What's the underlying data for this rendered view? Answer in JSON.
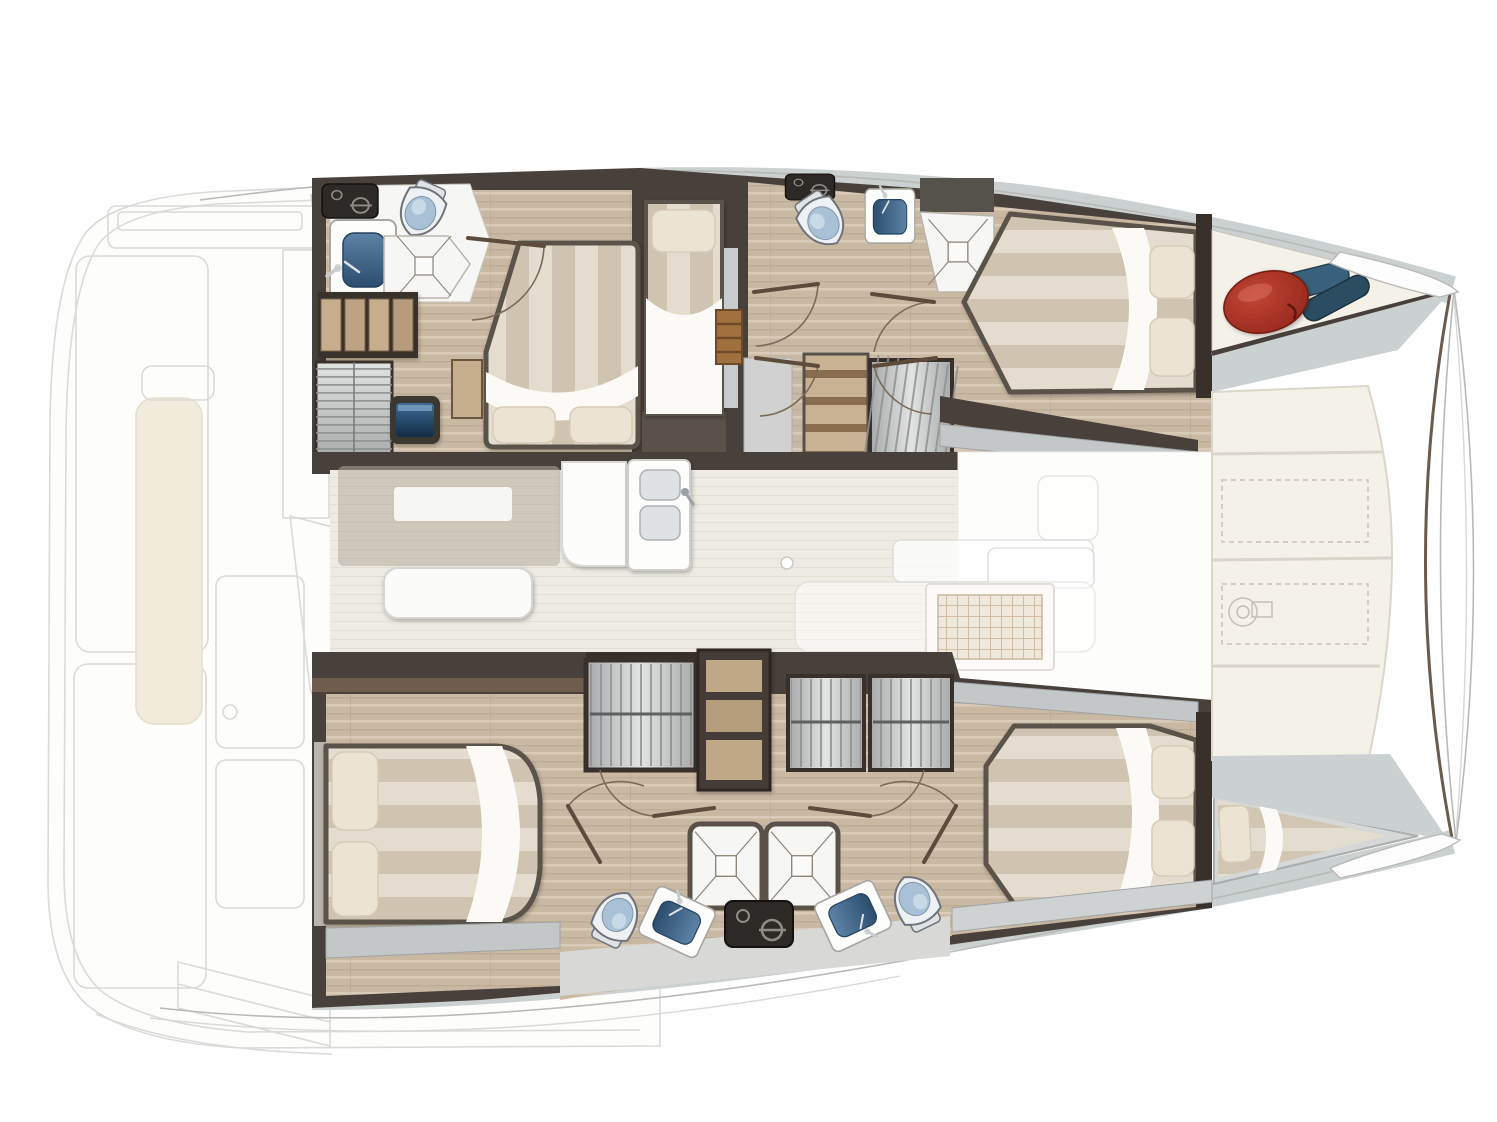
{
  "meta": {
    "type": "yacht-floor-plan",
    "vessel": "catamaran",
    "view": "top-down-deck-plan",
    "orientation": {
      "bow": "right",
      "stern": "left"
    },
    "canvas": {
      "width": 1497,
      "height": 1122
    }
  },
  "regions": [
    {
      "id": "aft-cockpit-ghost",
      "rendered": "faint-outline"
    },
    {
      "id": "port-hull-aft-cabin",
      "rendered": "solid"
    },
    {
      "id": "port-hull-aft-bathroom",
      "rendered": "solid"
    },
    {
      "id": "port-hull-single-berth-cabin",
      "rendered": "solid"
    },
    {
      "id": "port-hull-forward-cabin",
      "rendered": "solid"
    },
    {
      "id": "port-hull-forward-bathroom",
      "rendered": "solid"
    },
    {
      "id": "port-forepeak-gear-locker",
      "rendered": "solid"
    },
    {
      "id": "salon-galley",
      "rendered": "solid"
    },
    {
      "id": "foredeck-lockers",
      "rendered": "solid"
    },
    {
      "id": "starboard-hull-aft-cabin",
      "rendered": "solid"
    },
    {
      "id": "starboard-hull-bathrooms",
      "rendered": "solid"
    },
    {
      "id": "starboard-hull-forward-cabin",
      "rendered": "solid"
    },
    {
      "id": "starboard-forepeak-berth",
      "rendered": "solid"
    }
  ],
  "fixture_counts": {
    "double_beds": 4,
    "single_berths": 2,
    "toilets": 4,
    "showers": 4,
    "bathroom_sinks": 4,
    "galley_sink_bowls": 2,
    "hanging_lockers": 4,
    "shelf_units": 2,
    "companionway_stairs": 3,
    "door_swings": 9,
    "tv_screens": 1
  },
  "deck_details": {
    "locker_panels": 4,
    "dashed_hatches": 2,
    "windlass_symbol": true,
    "bow_gear": [
      "red-fender",
      "blue-fender-pair"
    ]
  },
  "palette": {
    "white": "#ffffff",
    "wall": "#48403a",
    "wallDark": "#38312b",
    "trimBrown": "#6f5e4d",
    "woodFloor": "#c9b8a2",
    "woodFloorLight": "#ddd0bd",
    "salonFloor": "#edebe3",
    "salonStreak": "#e2dfd5",
    "deckMarble": "#cbd0d0",
    "grayWood": "#c3c7c8",
    "grayWoodLine": "#9fa4a6",
    "cream": "#f4f1e9",
    "creamLine": "#d9d5c8",
    "bedStripeLight": "#e4ddcf",
    "bedStripeDark": "#cfc4af",
    "sheetWhite": "#fbfaf6",
    "pillow": "#ece4d3",
    "pillowLine": "#d6cbb6",
    "bedFrame": "#5a5248",
    "fixtureBlack": "#2c2926",
    "fixtureGlyph": "#8f8c87",
    "sinkBlueA": "#5d83a6",
    "sinkBlueB": "#2c4d6e",
    "toiletLid": "#a9c1d6",
    "toiletBody": "#eef1f4",
    "toiletLine": "#6f747b",
    "showerFloor": "#f6f6f4",
    "showerLine": "#8d8679",
    "louverA": "#e2e3e3",
    "louverB": "#a7a9aa",
    "louverLine": "#8f9190",
    "ladderWood": "#a0713f",
    "ladderLine": "#6e4a26",
    "tvA": "#3f6c96",
    "tvB": "#122c44",
    "tvFrame": "#3a3732",
    "fenderA": "#c24534",
    "fenderB": "#8c2217",
    "gearBlue": "#3a617b",
    "gearBlueDark": "#2c4d61",
    "ghostLine": "#dadad8",
    "ghostFill": "#fdfdfc",
    "ghostCushion": "#f1ebdb",
    "doorArc": "#7a6a58",
    "doorLeaf": "#5d4c3c",
    "outline": "#b9b9b7",
    "outlineFaint": "#d8d8d6",
    "gridFill": "#efe8dc",
    "gridLine": "#d2bda4"
  }
}
